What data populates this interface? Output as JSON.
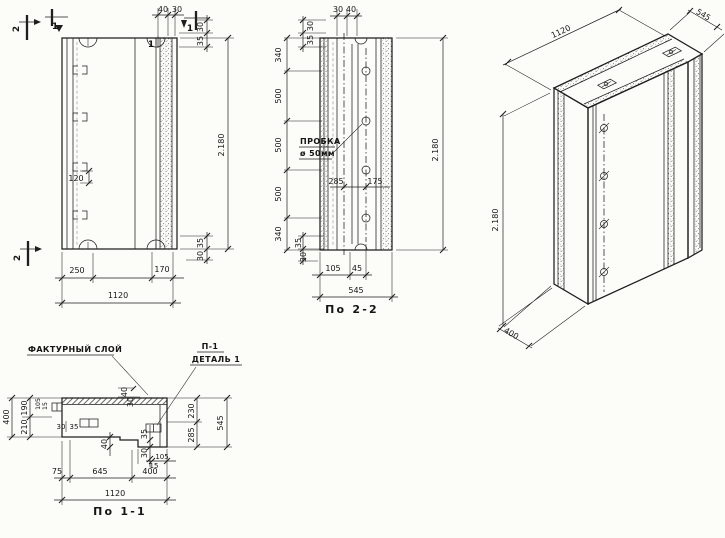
{
  "colors": {
    "paper": "#fcfcf9",
    "ink": "#1e1e1e"
  },
  "views": {
    "elevation": {
      "marks": {
        "sec2_top": "2",
        "sec1_top": "1",
        "sec1_right": "1",
        "sec1_edge": "1",
        "sec2_bottom": "2"
      },
      "dims": {
        "top_a": "40",
        "top_b": "30",
        "rt_a": "30",
        "rt_b": "35",
        "height": "2.180",
        "rb_a": "35",
        "rb_b": "30",
        "loop": "120",
        "bot_a": "250",
        "bot_b": "170",
        "bot_total": "1120"
      }
    },
    "section2": {
      "caption": "По 2-2",
      "plug_label": "ПРОБКА",
      "plug_dia": "ø 50мм",
      "dims": {
        "top_a": "30",
        "top_b": "40",
        "lt_a": "30",
        "lt_b": "35",
        "seg1": "340",
        "seg2": "500",
        "seg3": "500",
        "seg4": "500",
        "seg5": "340",
        "mid_a": "285",
        "mid_b": "175",
        "lb_a": "35",
        "lb_b": "30",
        "bot_a": "105",
        "bot_b": "45",
        "width": "545",
        "height": "2.180"
      }
    },
    "iso": {
      "dims": {
        "width": "1120",
        "depth": "545",
        "height": "2.180",
        "foot": "400"
      }
    },
    "section1": {
      "caption": "По 1-1",
      "texture_label": "ФАКТУРНЫЙ СЛОЙ",
      "detail_ref": "П-1",
      "detail_name": "ДЕТАЛЬ 1",
      "dims": {
        "left_total": "400",
        "left_a": "190",
        "left_b": "210",
        "tiny_a": "105",
        "tiny_b": "15",
        "hook_a": "30",
        "hook_b": "35",
        "mid_a": "40",
        "mid_b": "30",
        "step_a": "40",
        "step_b": "35",
        "step_c": "30",
        "step_d": "105",
        "step_e": "15",
        "bot_a": "75",
        "bot_b": "645",
        "bot_c": "400",
        "bot_total": "1120",
        "right_a": "230",
        "right_b": "285",
        "right_total": "545"
      }
    }
  }
}
